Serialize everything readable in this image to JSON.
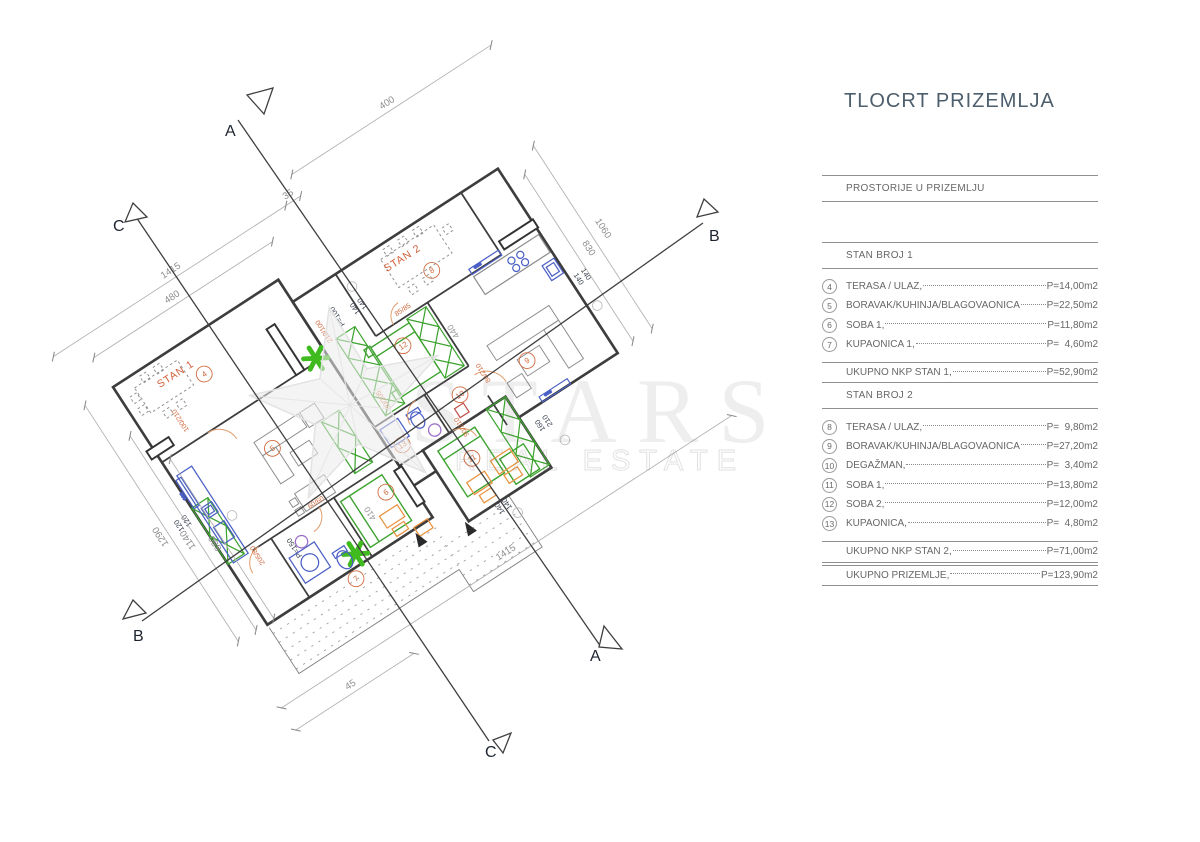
{
  "title": "TLOCRT PRIZEMLJA",
  "watermark": {
    "line1": "STARS",
    "line2": "REAL ESTATE"
  },
  "sections": {
    "a": "A",
    "b": "B",
    "c": "C"
  },
  "plan": {
    "stan1_label": "STAN 1",
    "stan2_label": "STAN 2",
    "rooms": [
      "4",
      "5",
      "6",
      "7",
      "8",
      "9",
      "10",
      "11",
      "12",
      "13"
    ],
    "dims": {
      "top_480": "480",
      "top_1415": "1415",
      "top_35": "35",
      "top_400": "400",
      "left_880": "880",
      "left_1140": "1140",
      "left_1290": "1290",
      "right_830": "830",
      "right_1060": "1060",
      "bottom_1415": "1415",
      "bottom_45": "45",
      "d140": "140",
      "d120": "120",
      "d160": "160",
      "d210": "210",
      "p100": "P=100",
      "p150": "P=150",
      "r410": "410",
      "r440": "440"
    },
    "openings": [
      "100/210",
      "210/100",
      "85/85",
      "80/205",
      "205/80",
      "60/60",
      "90/210",
      "80/210"
    ]
  },
  "table": {
    "header": "PROSTORIJE U PRIZEMLJU",
    "stan1": {
      "title": "STAN BROJ 1",
      "rows": [
        {
          "num": "4",
          "label": "TERASA / ULAZ,",
          "value": "P=14,00m2"
        },
        {
          "num": "5",
          "label": "BORAVAK/KUHINJA/BLAGOVAONICA",
          "value": "P=22,50m2"
        },
        {
          "num": "6",
          "label": "SOBA 1,",
          "value": "P=11,80m2"
        },
        {
          "num": "7",
          "label": "KUPAONICA 1,",
          "value": "P=  4,60m2"
        }
      ],
      "total_label": "UKUPNO NKP STAN 1,",
      "total_value": "P=52,90m2"
    },
    "stan2": {
      "title": "STAN BROJ 2",
      "rows": [
        {
          "num": "8",
          "label": "TERASA / ULAZ,",
          "value": "P=  9,80m2"
        },
        {
          "num": "9",
          "label": "BORAVAK/KUHINJA/BLAGOVAONICA",
          "value": "P=27,20m2"
        },
        {
          "num": "10",
          "label": "DEGAŽMAN,",
          "value": "P=  3,40m2"
        },
        {
          "num": "11",
          "label": "SOBA 1,",
          "value": "P=13,80m2"
        },
        {
          "num": "12",
          "label": "SOBA 2,",
          "value": "P=12,00m2"
        },
        {
          "num": "13",
          "label": "KUPAONICA,",
          "value": "P=  4,80m2"
        }
      ],
      "total_label": "UKUPNO NKP STAN 2,",
      "total_value": "P=71,00m2"
    },
    "grand_total_label": "UKUPNO PRIZEMLJE,",
    "grand_total_value": "P=123,90m2"
  }
}
